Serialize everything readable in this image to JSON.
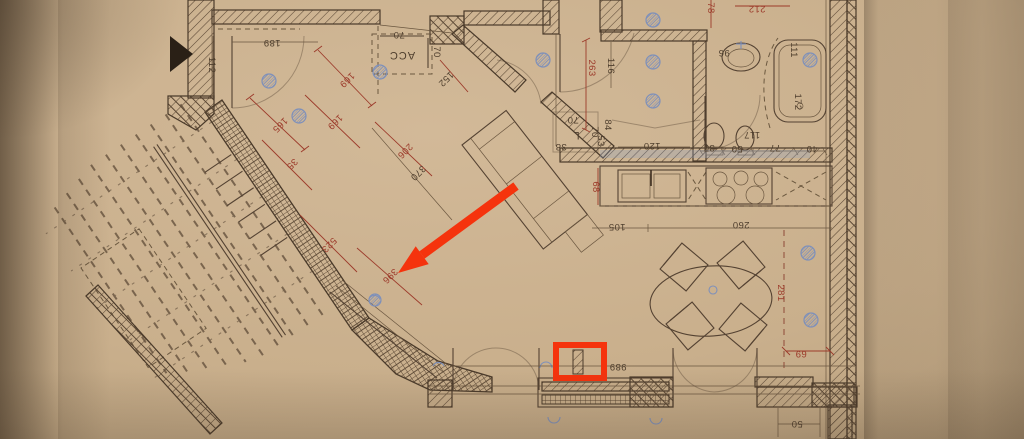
{
  "palette": {
    "paper": "#c9af8c",
    "ink": "#544232",
    "red_dimension": "#9c3a2a",
    "annotation_red": "#f5330d",
    "blue_symbol": "#7e90ba"
  },
  "annotation": {
    "color": "#f5330d",
    "arrow_target_label": "396",
    "highlight_target_label": "989"
  },
  "dims": {
    "d189": "189",
    "d112": "112",
    "d70a": "70",
    "dACC": "ACC",
    "d70b": "70",
    "d152": "152",
    "d116": "116",
    "d120": "120",
    "d96": "96",
    "d111": "111",
    "d172": "172",
    "d117": "117",
    "d37": "37",
    "d50a": "50",
    "d77": "77",
    "d40": "40",
    "d70c": "70",
    "dL": "L",
    "d70d": "70",
    "d84": "84",
    "d38": "38",
    "d53": "53",
    "d105": "105",
    "d260": "260",
    "d370": "370",
    "d989": "989",
    "d50b": "50",
    "r78": "78",
    "r212": "212",
    "r263": "263",
    "r169a": "169",
    "r169b": "169",
    "r165": "165",
    "r35": "35",
    "r206": "206",
    "r523": "523",
    "r396": "396",
    "r68": "68",
    "r281": "281",
    "r69": "69"
  }
}
